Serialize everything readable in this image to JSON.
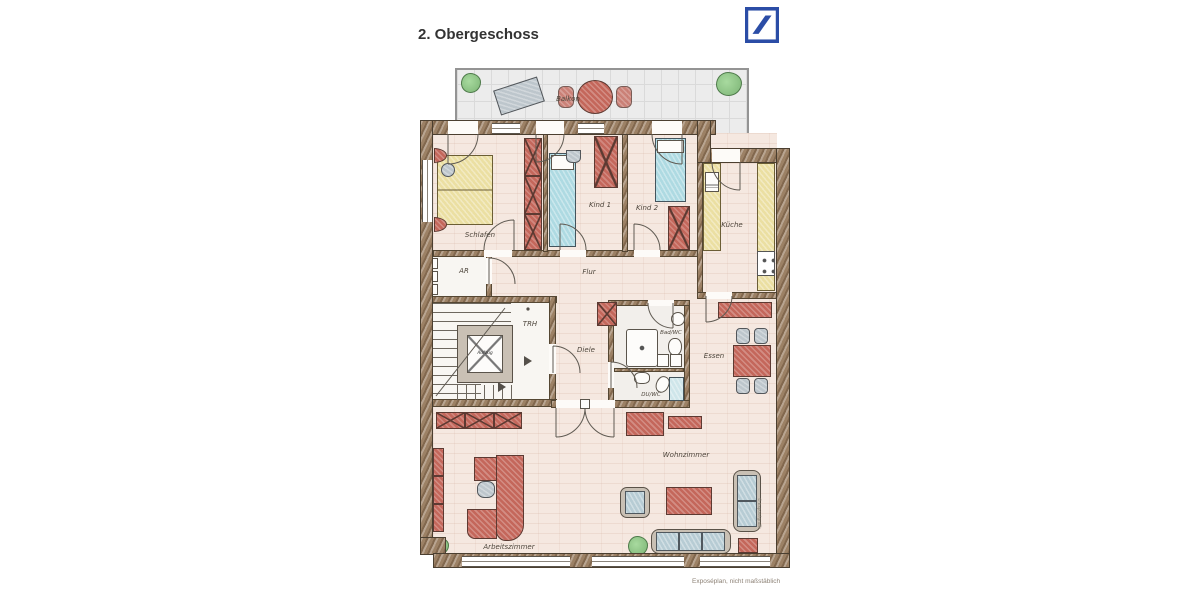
{
  "title": "2. Obergeschoss",
  "logo": {
    "name": "Deutsche Bank",
    "color": "#2b4da6"
  },
  "caption": "Exposéplan, nicht maßstäblich",
  "side_note": "© Exposégrafik",
  "rooms": {
    "balkon": "Balkon",
    "schlafen": "Schlafen",
    "kind1": "Kind 1",
    "kind2": "Kind 2",
    "kueche": "Küche",
    "ar": "AR",
    "flur": "Flur",
    "trh": "TRH",
    "aufzug": "Aufzug",
    "diele": "Diele",
    "badwc": "Bad/WC",
    "duwc": "DU/WC",
    "essen": "Essen",
    "wohnzimmer": "Wohnzimmer",
    "arbeitszimmer": "Arbeitszimmer"
  },
  "colors": {
    "wall": "#9c8165",
    "floor": "#f5e8e0",
    "furniture_red": "#c4675b",
    "bed_yellow": "#ebdfa2",
    "bed_blue": "#aedae2",
    "furniture_gray": "#bdc6cc",
    "plant_green": "#7cb475",
    "balcony_floor": "#ececec",
    "logo_blue": "#2b4da6"
  }
}
